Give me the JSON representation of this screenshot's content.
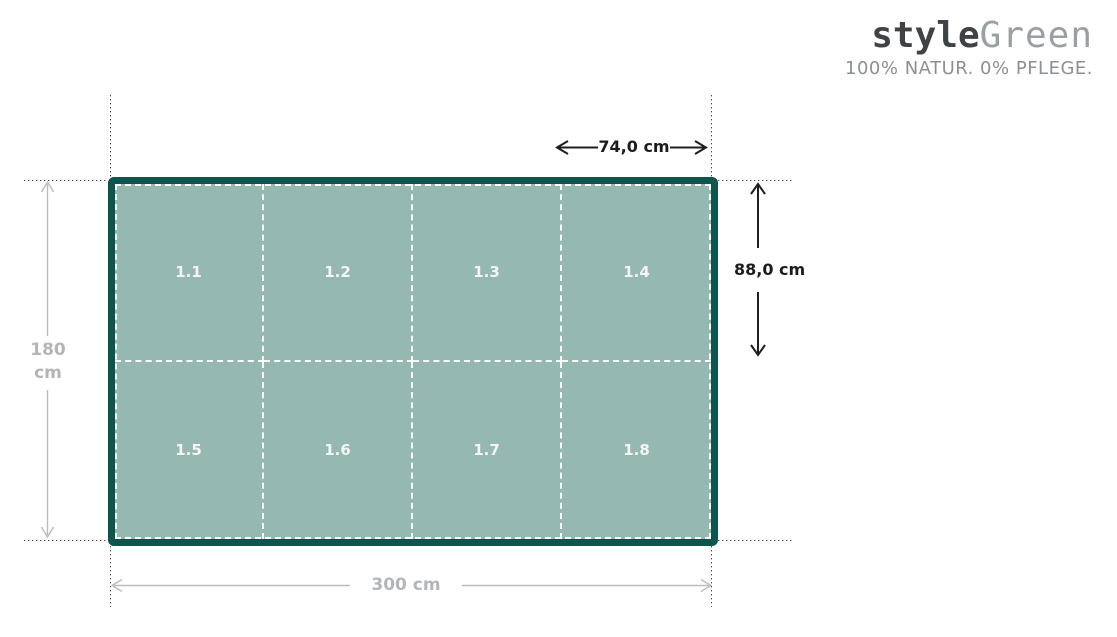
{
  "logo": {
    "brand_style": "style",
    "brand_green": "Green",
    "tagline": "100% NATUR. 0% PFLEGE."
  },
  "panel": {
    "rows": 2,
    "cols": 4,
    "cell_labels": [
      "1.1",
      "1.2",
      "1.3",
      "1.4",
      "1.5",
      "1.6",
      "1.7",
      "1.8"
    ]
  },
  "dimensions": {
    "cell_width": "74,0 cm",
    "cell_height": "88,0 cm",
    "total_height_line1": "180",
    "total_height_line2": "cm",
    "total_width": "300 cm"
  },
  "colors": {
    "panel_fill": "#95b9b1",
    "panel_border": "#0e554d",
    "cell_divider": "#ffffff",
    "dimension_black": "#1c1c1c",
    "dimension_gray": "#b3b6b9",
    "guide_dotted": "#4b4b4b",
    "logo_dark": "#3f4346",
    "logo_light": "#9aa0a2",
    "tagline_gray": "#8b9094"
  }
}
